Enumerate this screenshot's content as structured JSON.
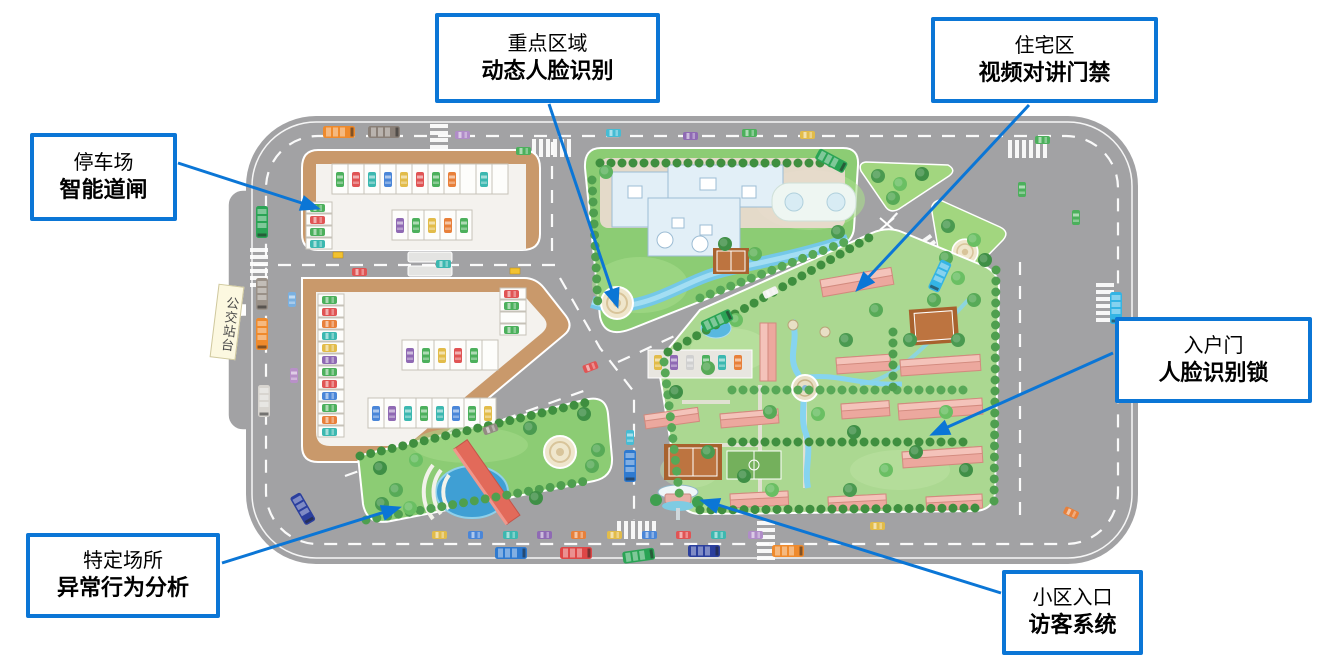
{
  "palette": {
    "callout_border": "#0b76d6",
    "arrow": "#0b76d6",
    "road": "#a2a2a4",
    "parking_border": "#c9996b",
    "block_green": "#8ccc74",
    "residential_green": "#abd891",
    "water": "#5fb8e0",
    "building_pink": "#eca89e"
  },
  "map": {
    "bus_stop_label": "公交站台"
  },
  "callouts": {
    "parking": {
      "line1": "停车场",
      "line2": "智能道闸"
    },
    "key_area": {
      "line1": "重点区域",
      "line2": "动态人脸识别"
    },
    "residential": {
      "line1": "住宅区",
      "line2": "视频对讲门禁"
    },
    "entry_door": {
      "line1": "入户门",
      "line2": "人脸识别锁"
    },
    "specific_place": {
      "line1": "特定场所",
      "line2": "异常行为分析"
    },
    "entrance": {
      "line1": "小区入口",
      "line2": "访客系统"
    }
  }
}
